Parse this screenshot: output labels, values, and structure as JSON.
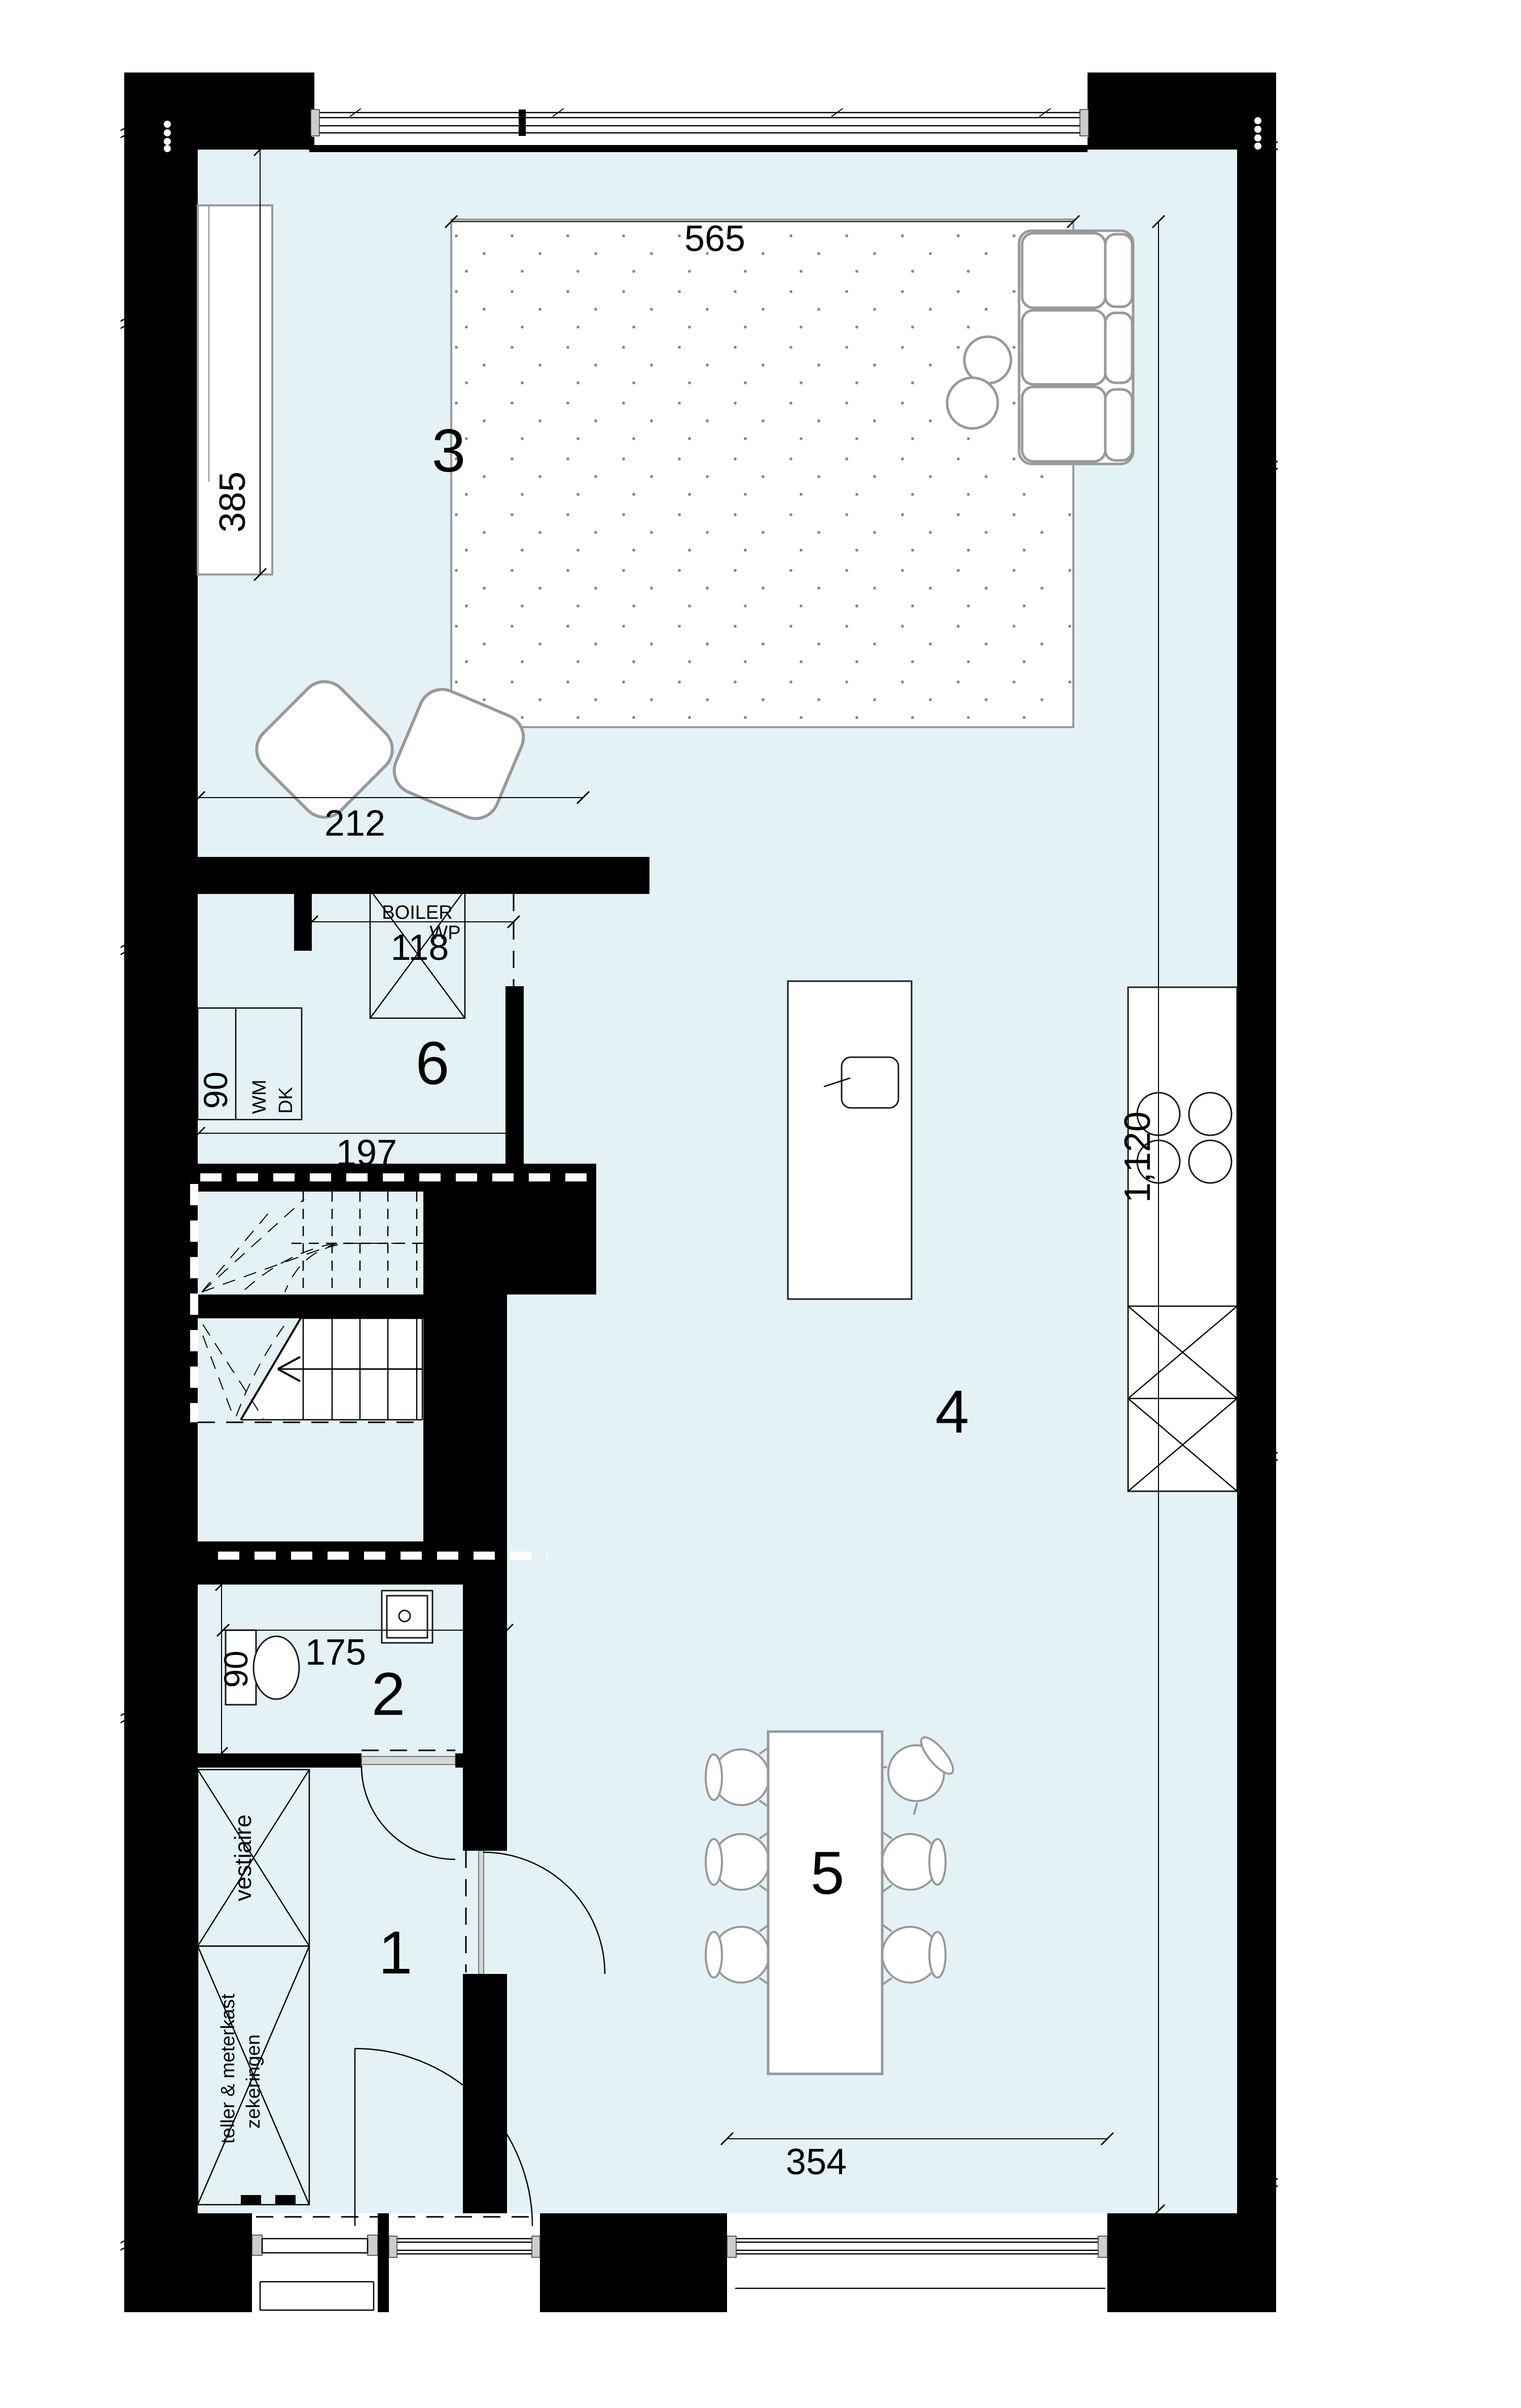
{
  "plan": {
    "rooms": {
      "hall": {
        "number": "1"
      },
      "toilet": {
        "number": "2"
      },
      "living": {
        "number": "3"
      },
      "kitchen": {
        "number": "4"
      },
      "dining": {
        "number": "5"
      },
      "utility": {
        "number": "6"
      }
    },
    "dimensions": {
      "rug_width": "565",
      "cabinet_length": "385",
      "chair_zone": "212",
      "boiler_width": "118",
      "utility_width": "197",
      "utility_depth": "90",
      "toilet_width": "175",
      "toilet_depth": "90",
      "interior_length": "1,120",
      "window_width": "354"
    },
    "labels": {
      "boiler": "BOILER",
      "heat_pump": "WP",
      "washer": "WM",
      "dryer": "DK",
      "wardrobe": "vestiaire",
      "meter_line1": "teller & meterkast",
      "meter_line2": "zekeringen"
    },
    "colors": {
      "floor": "#e4f2f5",
      "wall": "#000000",
      "furniture": "#999999",
      "door": "#d6d6d6"
    }
  }
}
